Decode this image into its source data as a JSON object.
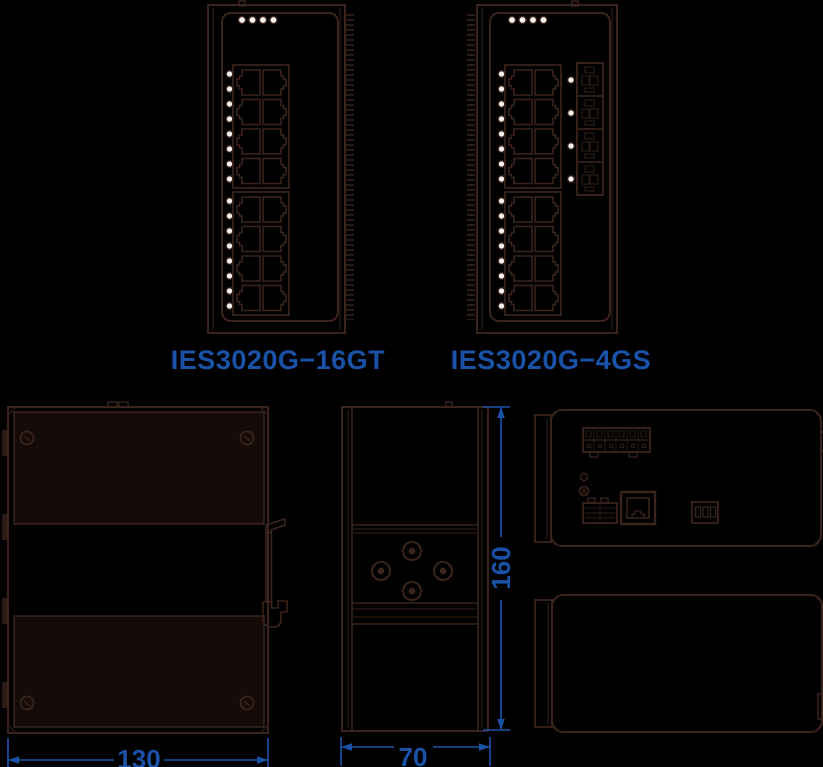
{
  "colors": {
    "background": "#000000",
    "line": "#3a241c",
    "line_soft": "#2c1b15",
    "panel_fill": "#150c0a",
    "led": "#f8f3ef",
    "accent_blue": "#1a52a8"
  },
  "products": [
    {
      "model": "IES3020G−16GT",
      "copper_ports": 16,
      "sfp_ports": 0,
      "status_leds_top": 4,
      "port_leds": 16
    },
    {
      "model": "IES3020G−4GS",
      "copper_ports": 16,
      "sfp_ports": 4,
      "status_leds_top": 4,
      "port_leds": 20
    }
  ],
  "dimensions_mm": {
    "width": "130",
    "depth": "70",
    "height": "160"
  }
}
